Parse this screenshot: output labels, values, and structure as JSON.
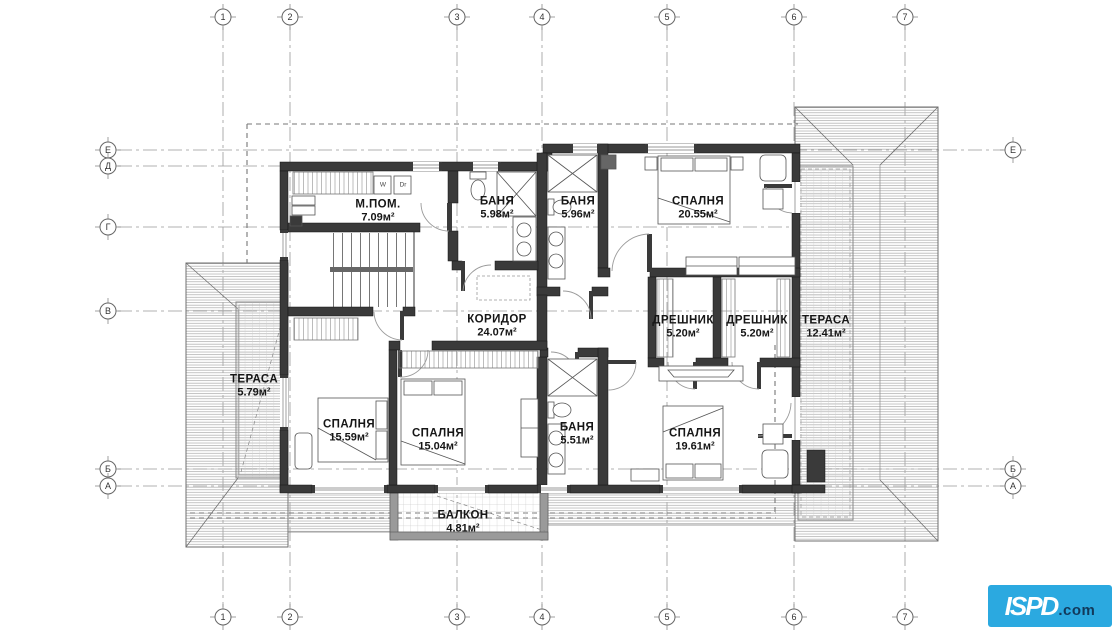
{
  "drawing": {
    "type_label": "floor-plan",
    "grid": {
      "columns": [
        {
          "label": "1",
          "x": 223
        },
        {
          "label": "2",
          "x": 290
        },
        {
          "label": "3",
          "x": 457
        },
        {
          "label": "4",
          "x": 542
        },
        {
          "label": "5",
          "x": 667
        },
        {
          "label": "6",
          "x": 794
        },
        {
          "label": "7",
          "x": 905
        }
      ],
      "rows": [
        {
          "label": "Е",
          "y": 150,
          "x2": 1003,
          "right": true
        },
        {
          "label": "Д",
          "y": 166,
          "x2": 548,
          "right": false
        },
        {
          "label": "Г",
          "y": 227,
          "x2": 795,
          "right": false
        },
        {
          "label": "В",
          "y": 311,
          "x2": 788,
          "right": false
        },
        {
          "label": "Б",
          "y": 469,
          "x2": 1003,
          "right": true
        },
        {
          "label": "А",
          "y": 486,
          "x2": 1003,
          "right": true
        }
      ]
    },
    "rooms": [
      {
        "name": "М.ПОМ.",
        "area": "7.09м²",
        "cx": 378,
        "cy": 211
      },
      {
        "name": "БАНЯ",
        "area": "5.98м²",
        "cx": 497,
        "cy": 208
      },
      {
        "name": "БАНЯ",
        "area": "5.96м²",
        "cx": 578,
        "cy": 208
      },
      {
        "name": "СПАЛНЯ",
        "area": "20.55м²",
        "cx": 698,
        "cy": 208
      },
      {
        "name": "КОРИДОР",
        "area": "24.07м²",
        "cx": 497,
        "cy": 326
      },
      {
        "name": "ДРЕШНИК",
        "area": "5.20м²",
        "cx": 683,
        "cy": 327
      },
      {
        "name": "ДРЕШНИК",
        "area": "5.20м²",
        "cx": 757,
        "cy": 327
      },
      {
        "name": "ТЕРАСА",
        "area": "12.41м²",
        "cx": 826,
        "cy": 327
      },
      {
        "name": "ТЕРАСА",
        "area": "5.79м²",
        "cx": 254,
        "cy": 386
      },
      {
        "name": "СПАЛНЯ",
        "area": "15.59м²",
        "cx": 349,
        "cy": 431
      },
      {
        "name": "СПАЛНЯ",
        "area": "15.04м²",
        "cx": 438,
        "cy": 440
      },
      {
        "name": "БАНЯ",
        "area": "5.51м²",
        "cx": 577,
        "cy": 434
      },
      {
        "name": "СПАЛНЯ",
        "area": "19.61м²",
        "cx": 695,
        "cy": 440
      },
      {
        "name": "БАЛКОН",
        "area": "4.81м²",
        "cx": 463,
        "cy": 522
      }
    ],
    "appliances": [
      {
        "label": "W",
        "x": 383,
        "y": 185
      },
      {
        "label": "Dr",
        "x": 403,
        "y": 185
      }
    ]
  },
  "logo": {
    "text_main": "ISPD",
    "text_suffix": ".com",
    "bg_color": "#2BA9E0",
    "suffix_color": "#12395A"
  }
}
